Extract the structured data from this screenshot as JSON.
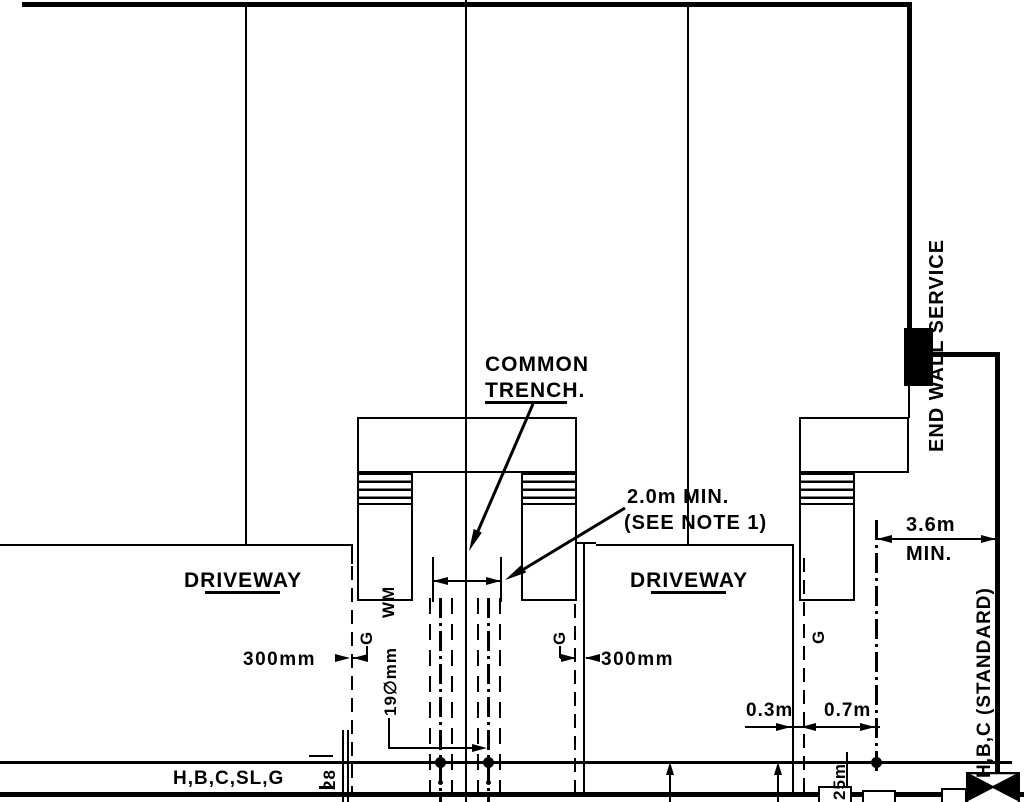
{
  "drawing": {
    "background": "#ffffff",
    "ink": "#000000",
    "labels": {
      "common_trench_line1": "COMMON",
      "common_trench_line2": "TRENCH.",
      "trench_width_note": "2.0m MIN.",
      "trench_width_note2": "(SEE NOTE 1)",
      "driveway_left": "DRIVEWAY",
      "driveway_right": "DRIVEWAY",
      "offset_left": "300mm",
      "offset_middle": "300mm",
      "offset_03": "0.3m",
      "offset_07": "0.7m",
      "end_setback": "3.6m",
      "end_setback_min": "MIN.",
      "end_wall_service": "END WALL SERVICE",
      "standard_service": "H,B,C (STANDARD)",
      "street_services": "H,B,C,SL,G",
      "gas_left": "G",
      "gas_middle": "G",
      "gas_right": "G",
      "water_main": "WM",
      "water_size": "19∅mm",
      "dim_28": "28",
      "dim_25m": "25m"
    }
  }
}
